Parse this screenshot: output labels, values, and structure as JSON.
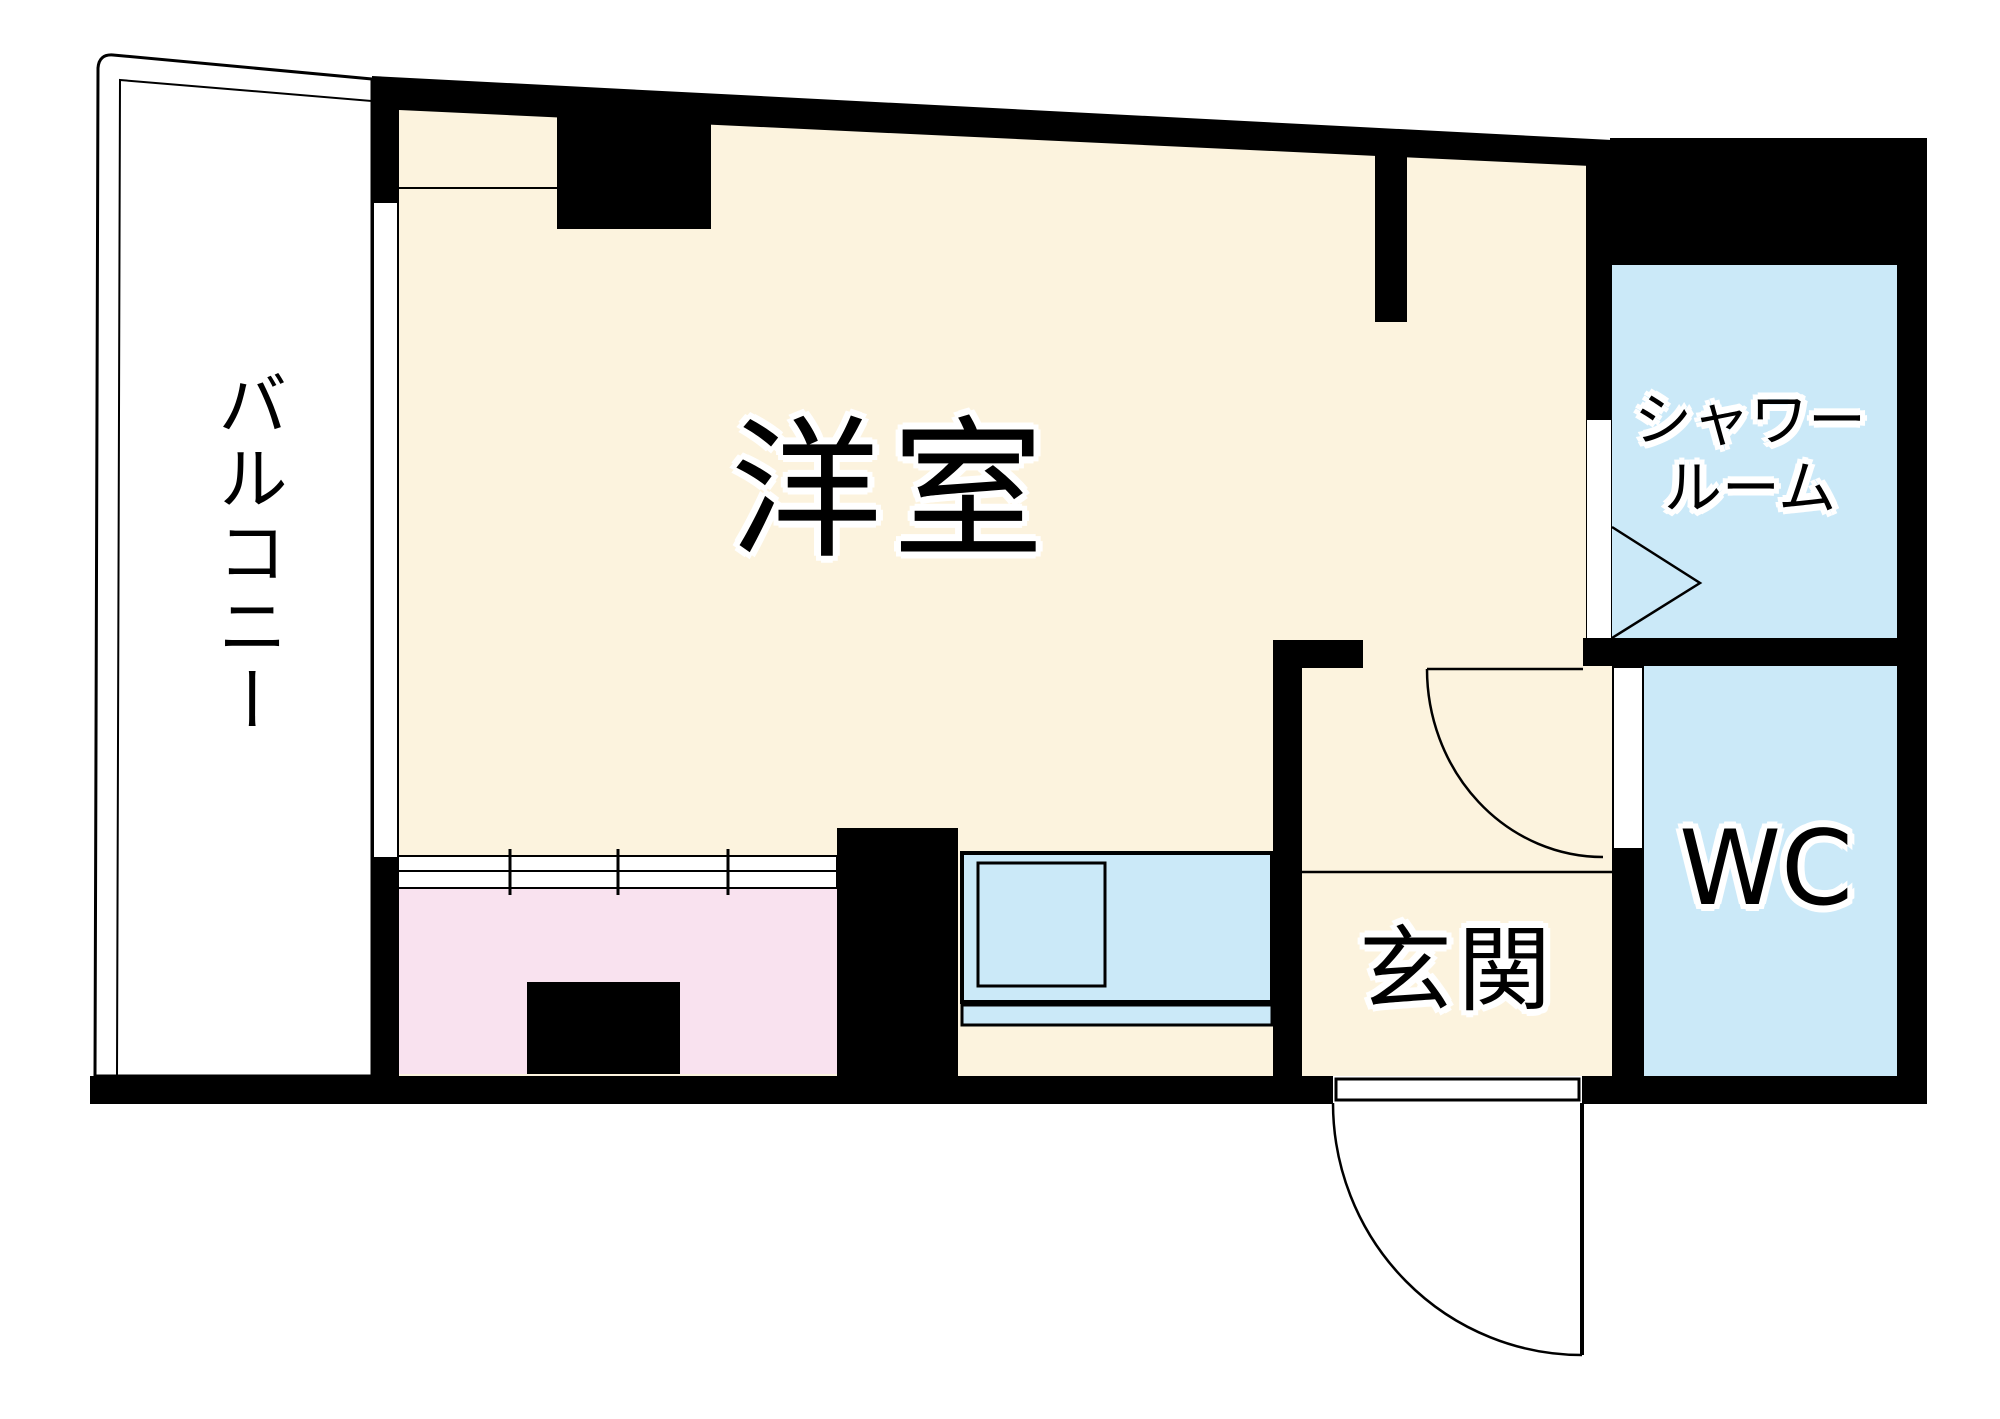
{
  "plan": {
    "rooms": {
      "balcony_label": "バルコニー",
      "main_room_label": "洋室",
      "shower_label_line1": "シャワー",
      "shower_label_line2": "ルーム",
      "wc_label": "WC",
      "entrance_label": "玄関"
    },
    "colors": {
      "wall": "#000000",
      "floor_cream": "#FCF3DE",
      "floor_pink": "#F9E2EF",
      "floor_blue": "#CBE9F8",
      "background": "#FFFFFF",
      "label_text": "#000000",
      "label_outline": "#FFFFFF"
    }
  }
}
